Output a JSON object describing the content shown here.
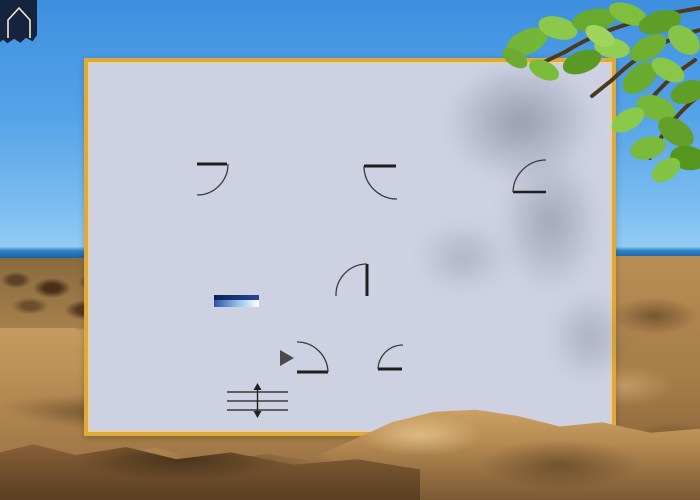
{
  "meta": {
    "description": "Apartment floor plan panel overlaid on a sunny beach photo with overhanging tree branch",
    "visible_text": []
  },
  "background": {
    "elements": [
      "sky",
      "sea",
      "rocky-shore",
      "sand-dunes",
      "foreground-dune",
      "tree-branch-with-leaves",
      "leaf-shadows"
    ],
    "sky_color_top": "#3e8fdf",
    "sky_color_bottom": "#9ad0f5",
    "sea_color": "#11589c",
    "sand_color": "#c09459",
    "leaf_color": "#74b637"
  },
  "logo": {
    "icon": "house-icon",
    "color": "#16233f",
    "outline": "#f5ecd0",
    "label": "house logo"
  },
  "floorplan": {
    "label": "apartment floor plan",
    "panel": {
      "border_color": "#e0a93c",
      "background_color": "#cdd1e2"
    },
    "wall_color": "#595959",
    "floor_color": "#faf4e6",
    "door_count": 6,
    "accent_colors": {
      "orange_furniture": "#e8935f",
      "yellow_furniture": "#f2d84e",
      "green_furniture": "#aed6a0",
      "counter_yellow": "#f5eda2",
      "tv_blue": "#1d3c8c"
    },
    "rooms": [
      {
        "id": "living-dining-kitchen",
        "label": "living and dining room with open kitchen",
        "furniture": [
          "sideboard",
          "kitchen-counter",
          "kitchen-sink",
          "stove",
          "dining-table",
          "dining-chair",
          "dining-chair",
          "dining-chair",
          "dining-chair",
          "sofa",
          "throw-pillow",
          "potted-plant",
          "tv-lowboard"
        ]
      },
      {
        "id": "bedroom",
        "label": "bedroom with balcony door",
        "furniture": [
          "wall-shelf",
          "potted-plant",
          "armchair",
          "double-bed",
          "bed-pillow",
          "bed-pillow",
          "wardrobe"
        ]
      },
      {
        "id": "tv-lounge",
        "label": "second lounge room",
        "furniture": [
          "potted-plant",
          "loveseat-sofa",
          "throw-pillow",
          "armchair",
          "coffee-table"
        ]
      },
      {
        "id": "hallway",
        "label": "entrance hallway",
        "furniture": [
          "console-shelf",
          "entrance-arrow"
        ]
      },
      {
        "id": "bathroom",
        "label": "bathroom",
        "furniture": [
          "toilet",
          "shower",
          "washbasin"
        ]
      },
      {
        "id": "stairwell",
        "label": "staircase",
        "furniture": [
          "staircase",
          "up-down-arrow"
        ]
      }
    ]
  }
}
